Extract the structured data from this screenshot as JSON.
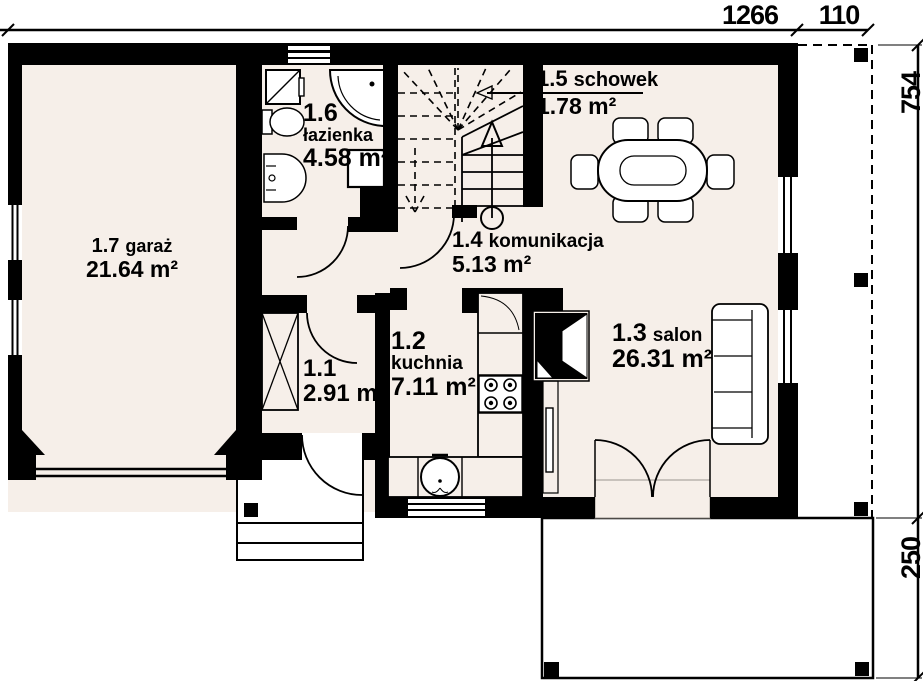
{
  "plan": {
    "dimensions": {
      "width_main": "1266",
      "width_overhang": "110",
      "height_main": "754",
      "terrace_depth": "250"
    },
    "rooms": [
      {
        "id": "1.1",
        "name": "",
        "area": "2.91 m²"
      },
      {
        "id": "1.2",
        "name": "kuchnia",
        "area": "7.11 m²"
      },
      {
        "id": "1.3",
        "name": "salon",
        "area": "26.31 m²"
      },
      {
        "id": "1.4",
        "name": "komunikacja",
        "area": "5.13 m²"
      },
      {
        "id": "1.5",
        "name": "schowek",
        "area": "1.78 m²"
      },
      {
        "id": "1.6",
        "name": "łazienka",
        "area": "4.58 m²"
      },
      {
        "id": "1.7",
        "name": "garaż",
        "area": "21.64 m²"
      }
    ],
    "colors": {
      "wall": "#000000",
      "floor": "#f6efe9",
      "background": "#ffffff"
    }
  }
}
